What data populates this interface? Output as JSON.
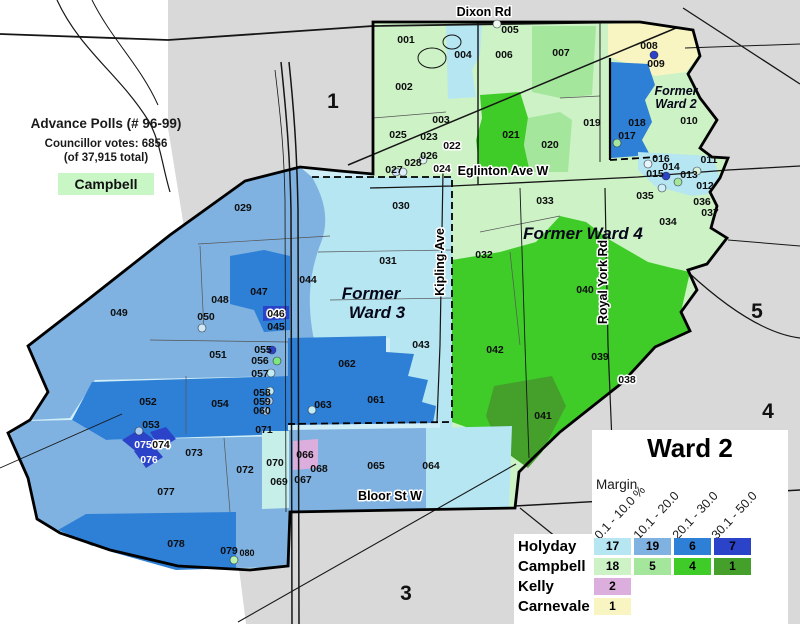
{
  "info_box": {
    "title": "Advance Polls (# 96-99)",
    "votes_line": "Councillor votes: 6856",
    "total_line": "(of 37,915 total)",
    "winner": "Campbell",
    "winner_color": "#c9f6c5"
  },
  "legend": {
    "title": "Ward 2",
    "margin_label": "Margin",
    "columns": [
      "0.1 - 10.0 %",
      "10.1 - 20.0",
      "20.1 - 30.0",
      "30.1 - 50.0"
    ],
    "rows": [
      {
        "name": "Holyday",
        "counts": [
          "17",
          "19",
          "6",
          "7"
        ],
        "colors": [
          "#b5e6f2",
          "#7fb2e0",
          "#2e7fd6",
          "#2b43c8"
        ]
      },
      {
        "name": "Campbell",
        "counts": [
          "18",
          "5",
          "4",
          "1"
        ],
        "colors": [
          "#cdf2c6",
          "#a4e69c",
          "#3fcc28",
          "#449f2b"
        ]
      },
      {
        "name": "Kelly",
        "counts": [
          "2"
        ],
        "colors": [
          "#dcaede"
        ]
      },
      {
        "name": "Carnevale",
        "counts": [
          "1"
        ],
        "colors": [
          "#f8f5c3"
        ]
      }
    ]
  },
  "map": {
    "palette": {
      "holyday": [
        "#b5e6f2",
        "#7fb2e0",
        "#2e7fd6",
        "#2b43c8"
      ],
      "campbell": [
        "#cdf2c6",
        "#a4e69c",
        "#3fcc28",
        "#449f2b"
      ],
      "kelly": "#dcaede",
      "carnevale": "#f8f5c3",
      "outside": "#d9d9d9"
    },
    "streets": [
      {
        "t": "Dixon Rd",
        "x": 484,
        "y": 16,
        "r": 0
      },
      {
        "t": "Eglinton Ave W",
        "x": 503,
        "y": 175,
        "r": 0
      },
      {
        "t": "Kipling Ave",
        "x": 444,
        "y": 262,
        "r": -90
      },
      {
        "t": "Royal York Rd",
        "x": 607,
        "y": 282,
        "r": -90
      },
      {
        "t": "Bloor St W",
        "x": 390,
        "y": 500,
        "r": 0
      }
    ],
    "areas": [
      {
        "t": "Former",
        "x": 676,
        "y": 95,
        "s": 12.5
      },
      {
        "t": "Ward 2",
        "x": 676,
        "y": 108,
        "s": 12.5
      },
      {
        "t": "Former",
        "x": 371,
        "y": 299,
        "s": 17
      },
      {
        "t": "Ward 3",
        "x": 377,
        "y": 318,
        "s": 17
      },
      {
        "t": "Former Ward 4",
        "x": 583,
        "y": 239,
        "s": 17
      }
    ],
    "regions": [
      {
        "t": "1",
        "x": 333,
        "y": 108
      },
      {
        "t": "3",
        "x": 406,
        "y": 600
      },
      {
        "t": "4",
        "x": 768,
        "y": 418
      },
      {
        "t": "5",
        "x": 757,
        "y": 318
      }
    ],
    "polls": [
      {
        "t": "001",
        "x": 406,
        "y": 43
      },
      {
        "t": "002",
        "x": 404,
        "y": 90
      },
      {
        "t": "003",
        "x": 441,
        "y": 123
      },
      {
        "t": "004",
        "x": 463,
        "y": 58
      },
      {
        "t": "005",
        "x": 510,
        "y": 33
      },
      {
        "t": "006",
        "x": 504,
        "y": 58
      },
      {
        "t": "007",
        "x": 561,
        "y": 56
      },
      {
        "t": "008",
        "x": 649,
        "y": 49
      },
      {
        "t": "009",
        "x": 656,
        "y": 67
      },
      {
        "t": "010",
        "x": 689,
        "y": 124
      },
      {
        "t": "011",
        "x": 709,
        "y": 163
      },
      {
        "t": "012",
        "x": 705,
        "y": 189
      },
      {
        "t": "013",
        "x": 689,
        "y": 178
      },
      {
        "t": "014",
        "x": 671,
        "y": 170
      },
      {
        "t": "015",
        "x": 655,
        "y": 177
      },
      {
        "t": "016",
        "x": 661,
        "y": 162
      },
      {
        "t": "017",
        "x": 627,
        "y": 139
      },
      {
        "t": "018",
        "x": 637,
        "y": 126
      },
      {
        "t": "019",
        "x": 592,
        "y": 126
      },
      {
        "t": "020",
        "x": 550,
        "y": 148
      },
      {
        "t": "021",
        "x": 511,
        "y": 138
      },
      {
        "t": "022",
        "x": 452,
        "y": 149,
        "h": 1
      },
      {
        "t": "023",
        "x": 429,
        "y": 140
      },
      {
        "t": "024",
        "x": 442,
        "y": 172,
        "h": 1
      },
      {
        "t": "025",
        "x": 398,
        "y": 138
      },
      {
        "t": "026",
        "x": 429,
        "y": 159
      },
      {
        "t": "027",
        "x": 394,
        "y": 173
      },
      {
        "t": "028",
        "x": 413,
        "y": 166
      },
      {
        "t": "029",
        "x": 243,
        "y": 211
      },
      {
        "t": "030",
        "x": 401,
        "y": 209
      },
      {
        "t": "031",
        "x": 388,
        "y": 264
      },
      {
        "t": "032",
        "x": 484,
        "y": 258
      },
      {
        "t": "033",
        "x": 545,
        "y": 204
      },
      {
        "t": "034",
        "x": 668,
        "y": 225
      },
      {
        "t": "035",
        "x": 645,
        "y": 199
      },
      {
        "t": "036",
        "x": 702,
        "y": 205
      },
      {
        "t": "037",
        "x": 710,
        "y": 216
      },
      {
        "t": "038",
        "x": 627,
        "y": 383,
        "h": 1
      },
      {
        "t": "039",
        "x": 600,
        "y": 360
      },
      {
        "t": "040",
        "x": 585,
        "y": 293
      },
      {
        "t": "041",
        "x": 543,
        "y": 419
      },
      {
        "t": "042",
        "x": 495,
        "y": 353
      },
      {
        "t": "043",
        "x": 421,
        "y": 348
      },
      {
        "t": "044",
        "x": 308,
        "y": 283
      },
      {
        "t": "045",
        "x": 276,
        "y": 330
      },
      {
        "t": "046",
        "x": 276,
        "y": 317,
        "h": 1
      },
      {
        "t": "047",
        "x": 259,
        "y": 295
      },
      {
        "t": "048",
        "x": 220,
        "y": 303
      },
      {
        "t": "049",
        "x": 119,
        "y": 316
      },
      {
        "t": "050",
        "x": 206,
        "y": 320
      },
      {
        "t": "051",
        "x": 218,
        "y": 358
      },
      {
        "t": "052",
        "x": 148,
        "y": 405
      },
      {
        "t": "053",
        "x": 151,
        "y": 428
      },
      {
        "t": "054",
        "x": 220,
        "y": 407
      },
      {
        "t": "055",
        "x": 263,
        "y": 353
      },
      {
        "t": "056",
        "x": 260,
        "y": 364
      },
      {
        "t": "057",
        "x": 260,
        "y": 377
      },
      {
        "t": "058",
        "x": 262,
        "y": 396
      },
      {
        "t": "059",
        "x": 262,
        "y": 405
      },
      {
        "t": "060",
        "x": 262,
        "y": 414
      },
      {
        "t": "061",
        "x": 376,
        "y": 403
      },
      {
        "t": "062",
        "x": 347,
        "y": 367
      },
      {
        "t": "063",
        "x": 323,
        "y": 408
      },
      {
        "t": "064",
        "x": 431,
        "y": 469
      },
      {
        "t": "065",
        "x": 376,
        "y": 469
      },
      {
        "t": "066",
        "x": 305,
        "y": 458
      },
      {
        "t": "067",
        "x": 303,
        "y": 483
      },
      {
        "t": "068",
        "x": 319,
        "y": 472
      },
      {
        "t": "069",
        "x": 279,
        "y": 485
      },
      {
        "t": "070",
        "x": 275,
        "y": 466
      },
      {
        "t": "071",
        "x": 264,
        "y": 433
      },
      {
        "t": "072",
        "x": 245,
        "y": 473
      },
      {
        "t": "073",
        "x": 194,
        "y": 456
      },
      {
        "t": "074",
        "x": 161,
        "y": 448,
        "h": 1
      },
      {
        "t": "075",
        "x": 143,
        "y": 448,
        "w": 1
      },
      {
        "t": "076",
        "x": 149,
        "y": 463,
        "w": 1
      },
      {
        "t": "077",
        "x": 166,
        "y": 495
      },
      {
        "t": "078",
        "x": 176,
        "y": 547
      },
      {
        "t": "079",
        "x": 229,
        "y": 554
      },
      {
        "t": "080",
        "x": 247,
        "y": 556,
        "s": 9
      }
    ],
    "dots": [
      {
        "cx": 497,
        "cy": 24,
        "f": "#eef9ee"
      },
      {
        "cx": 452,
        "cy": 145,
        "f": "#2e7fd6"
      },
      {
        "cx": 423,
        "cy": 160,
        "f": "#ddf1ee"
      },
      {
        "cx": 396,
        "cy": 172,
        "f": "#cfe3f5"
      },
      {
        "cx": 403,
        "cy": 172,
        "f": "#ddeefa"
      },
      {
        "cx": 654,
        "cy": 55,
        "f": "#2b43c8"
      },
      {
        "cx": 617,
        "cy": 143,
        "f": "#a4e69c"
      },
      {
        "cx": 666,
        "cy": 176,
        "f": "#2b43c8"
      },
      {
        "cx": 648,
        "cy": 164,
        "f": "#e8f6fb"
      },
      {
        "cx": 678,
        "cy": 182,
        "f": "#a4e69c"
      },
      {
        "cx": 697,
        "cy": 171,
        "f": "#d8f2d8"
      },
      {
        "cx": 662,
        "cy": 188,
        "f": "#cdeff7"
      },
      {
        "cx": 202,
        "cy": 328,
        "f": "#cfe9f7"
      },
      {
        "cx": 272,
        "cy": 350,
        "f": "#2b43c8"
      },
      {
        "cx": 277,
        "cy": 361,
        "f": "#7ce87c"
      },
      {
        "cx": 271,
        "cy": 373,
        "f": "#c2ecf4"
      },
      {
        "cx": 270,
        "cy": 391,
        "f": "#c2ecf4"
      },
      {
        "cx": 269,
        "cy": 401,
        "f": "#a9cdf0"
      },
      {
        "cx": 266,
        "cy": 411,
        "f": "#a9cdf0"
      },
      {
        "cx": 312,
        "cy": 410,
        "f": "#c2ecf4"
      },
      {
        "cx": 139,
        "cy": 431,
        "f": "#a9cdf0"
      },
      {
        "cx": 234,
        "cy": 560,
        "f": "#b5f2ae"
      }
    ]
  }
}
